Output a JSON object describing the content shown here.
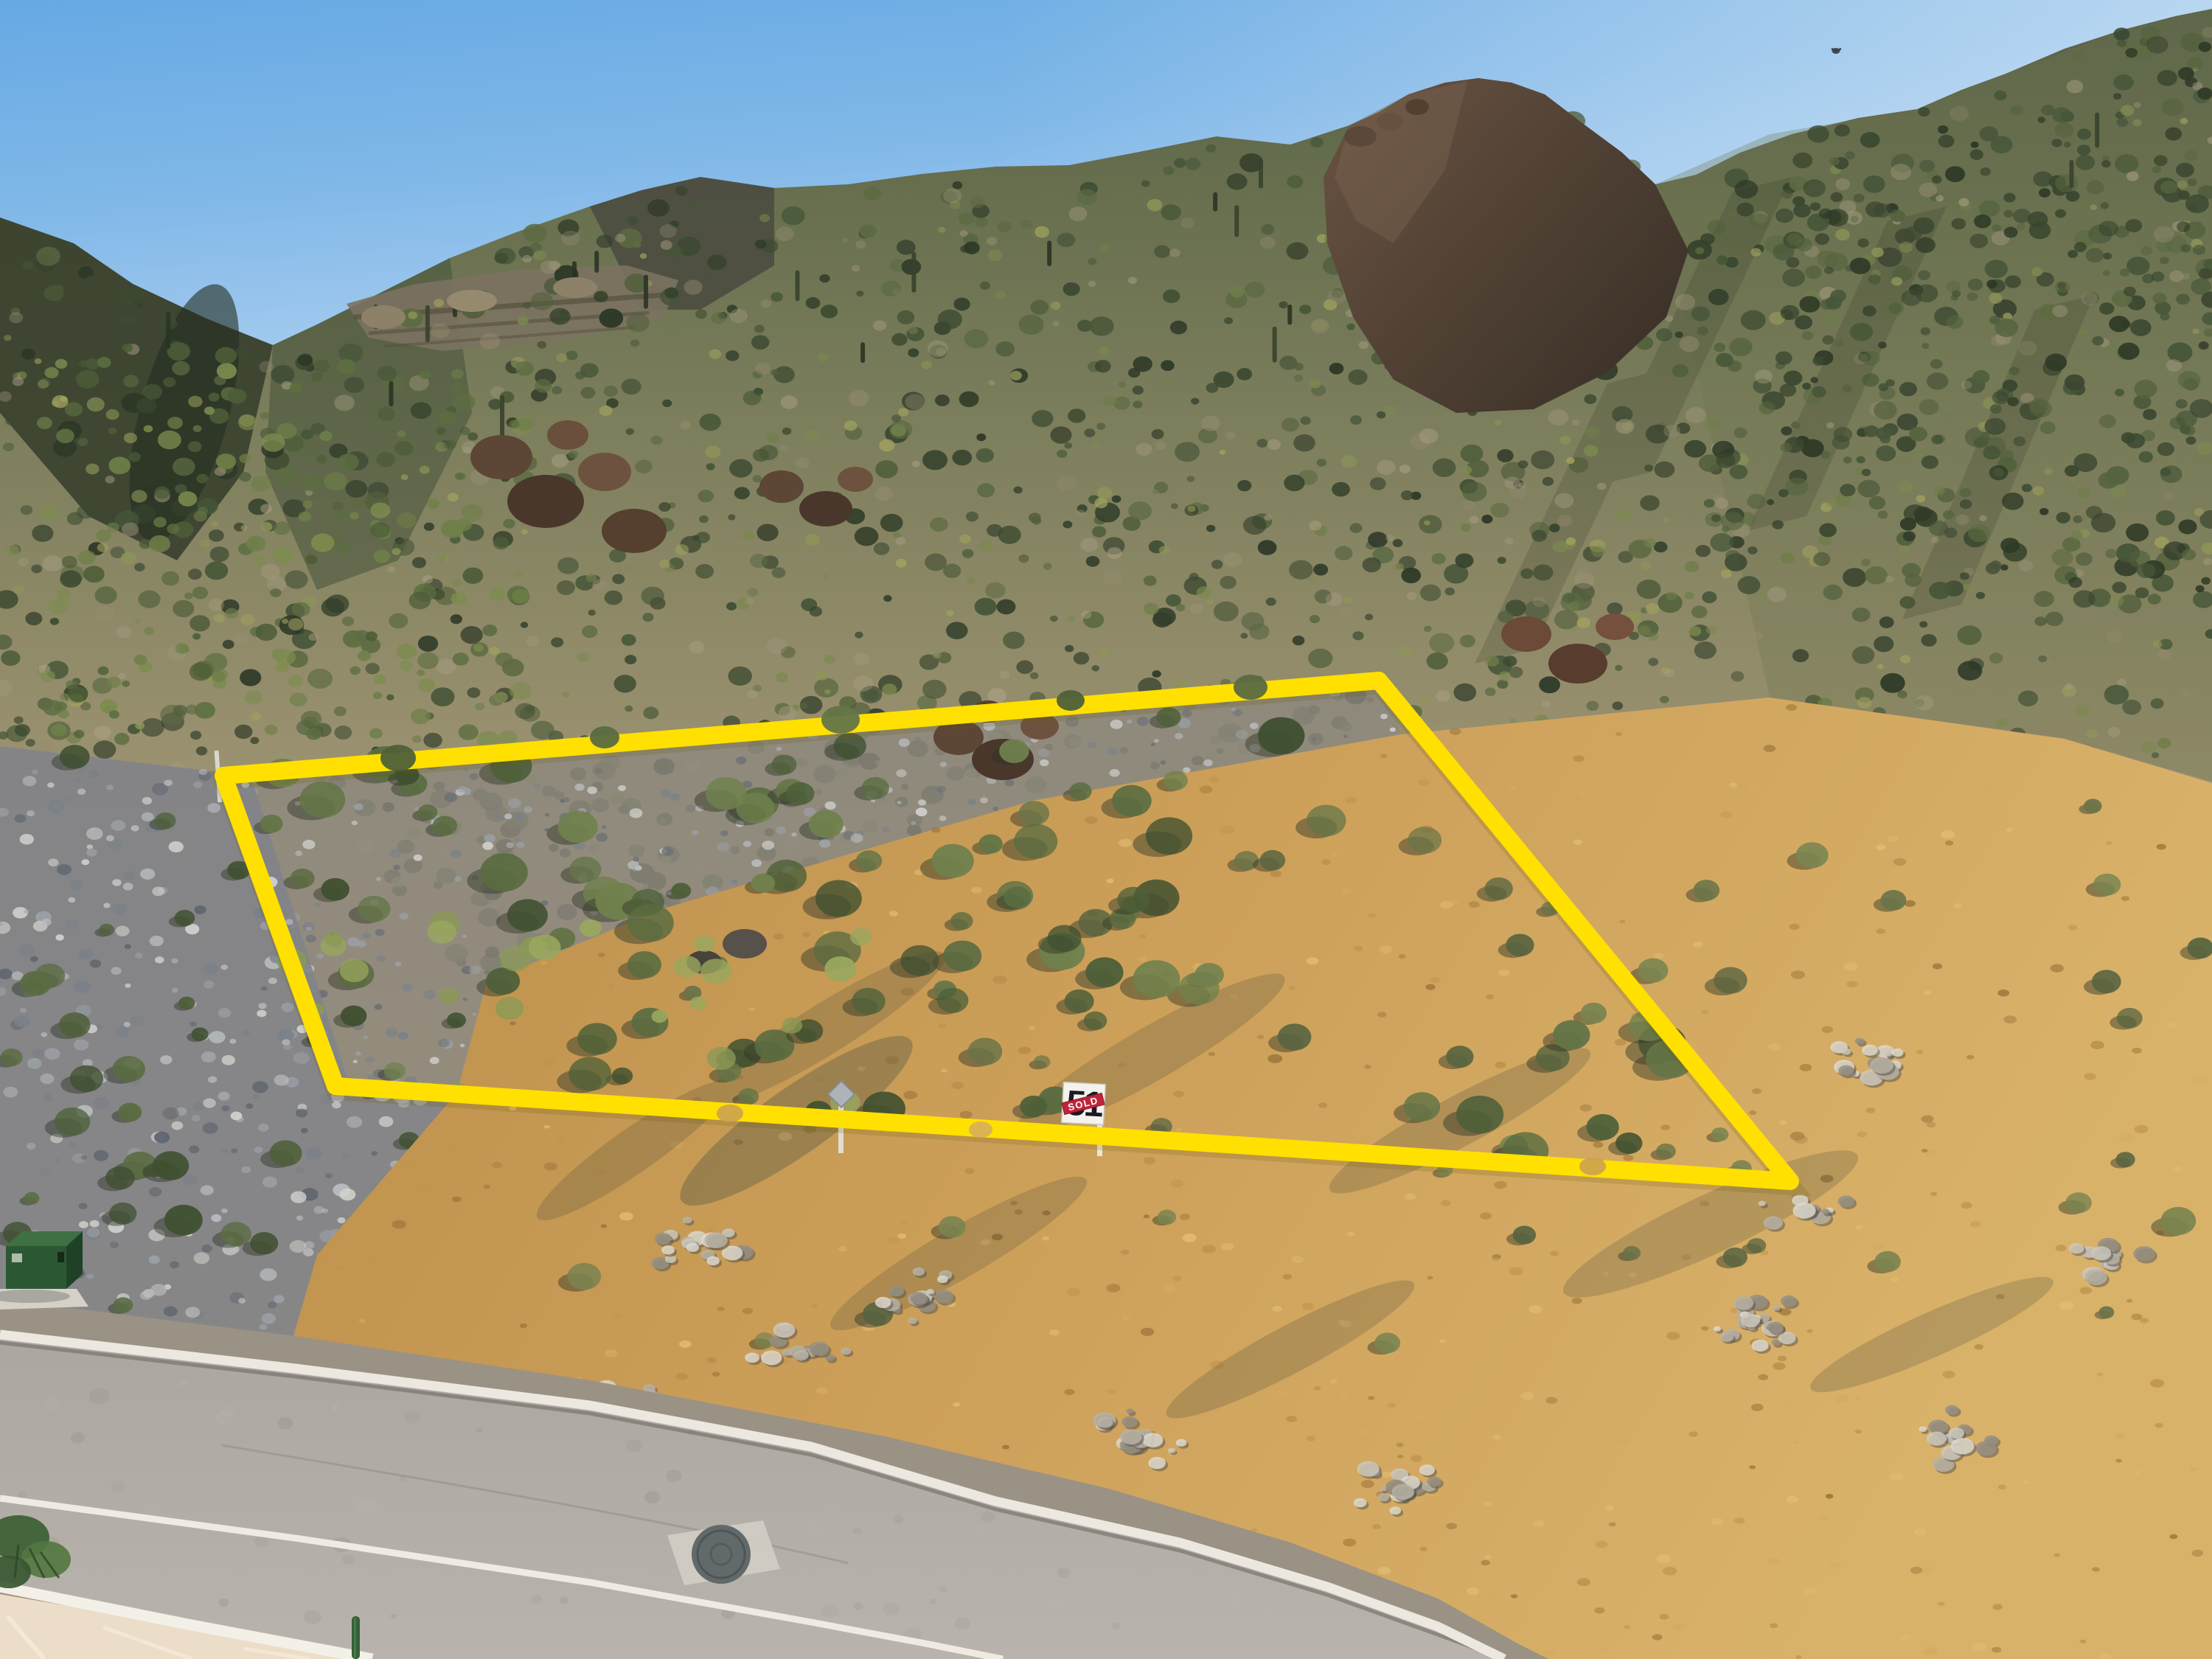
{
  "image": {
    "description": "Aerial drone photo of a desert mountainside lot outlined in yellow above a paved street; lot sign 51 marked SOLD"
  },
  "lot_sign": {
    "number": "51",
    "status": "SOLD"
  },
  "boundary": {
    "color": "#FFE000"
  },
  "colors": {
    "sky_top": "#66A9E3",
    "sky_horizon": "#D3E6F5",
    "grass_gold": "#C79A52",
    "road_gray": "#ADA9A2",
    "sign_red": "#C0243A",
    "utility_box_green": "#2C5733"
  }
}
